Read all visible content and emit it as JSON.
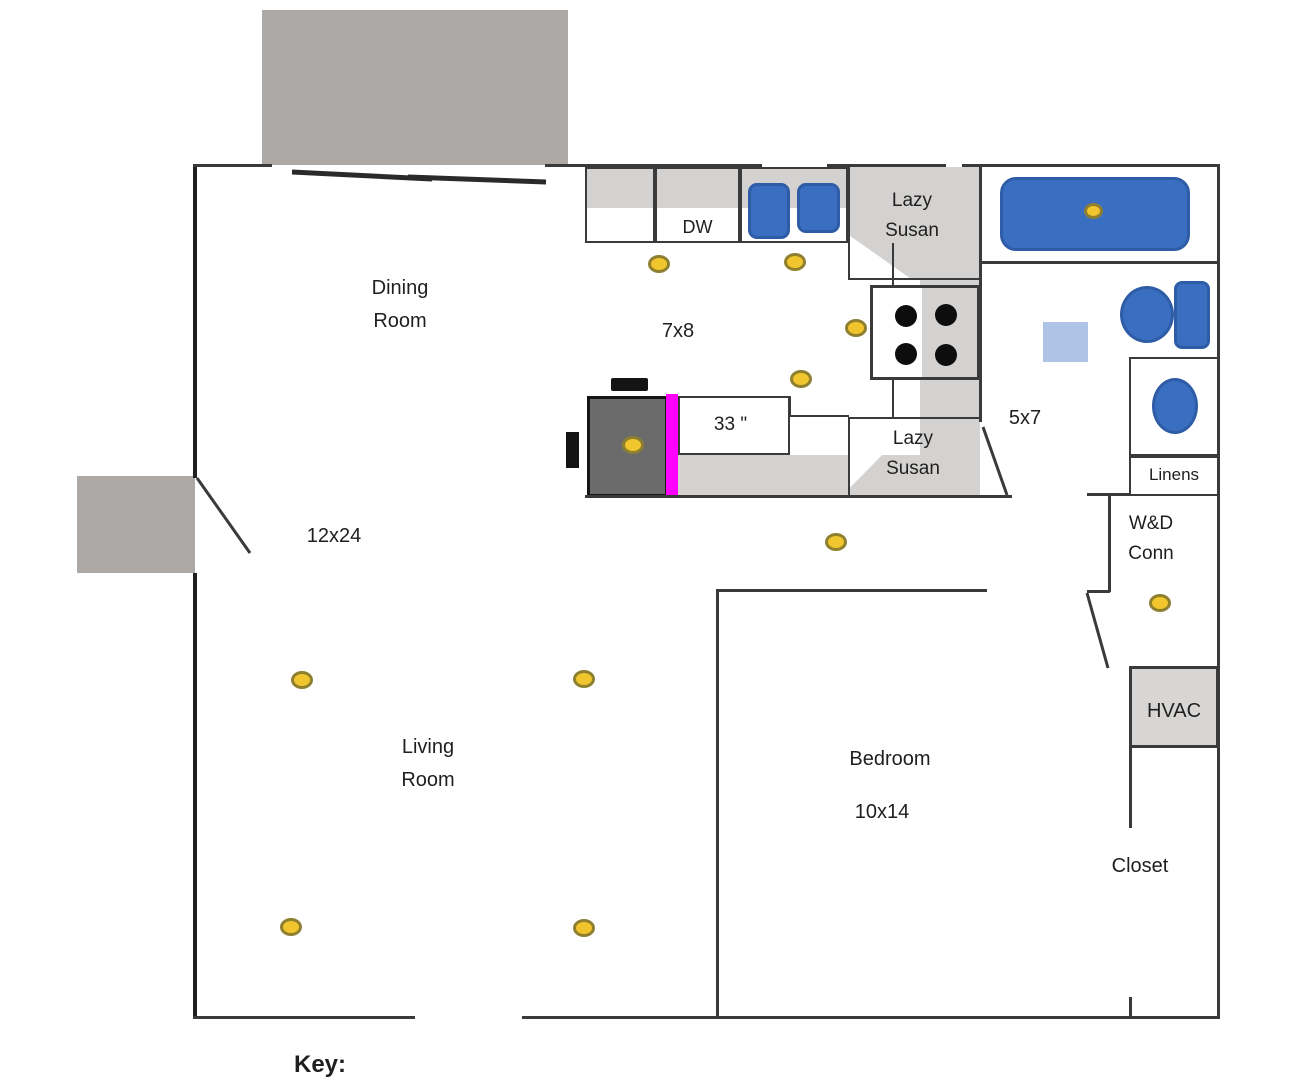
{
  "title": "House floor plan with lighting layout",
  "labels": {
    "dining_room": "Dining Room",
    "kitchen_size": "7x8",
    "dishwasher": "DW",
    "lazy_susan_top": "Lazy Susan",
    "lazy_susan_bottom": "Lazy Susan",
    "counter_width": "33 \"",
    "bath_size": "5x7",
    "linens": "Linens",
    "wd_conn": "W&D Conn",
    "living_size": "12x24",
    "living_room": "Living Room",
    "bedroom": "Bedroom",
    "bedroom_size": "10x14",
    "hvac": "HVAC",
    "closet": "Closet",
    "key": "Key:"
  },
  "symbols": {
    "ceiling_light": "yellow oval = ceiling light",
    "count_of_lights": 12
  },
  "colors": {
    "fixture_blue": "#3a6ec0",
    "fixture_blue_border": "#2e5ca6",
    "mat_light_blue": "#aec3e6",
    "light_yellow": "#f0c52e",
    "light_outline": "#8f8030",
    "counter_gray": "#d4d2d0",
    "deck_gray": "#aca9a6",
    "fridge_gray": "#6b6b6b",
    "hvac_gray": "#d8d6d4",
    "accent_magenta": "#ff00ff",
    "wall_dark": "#1f1f1f"
  }
}
